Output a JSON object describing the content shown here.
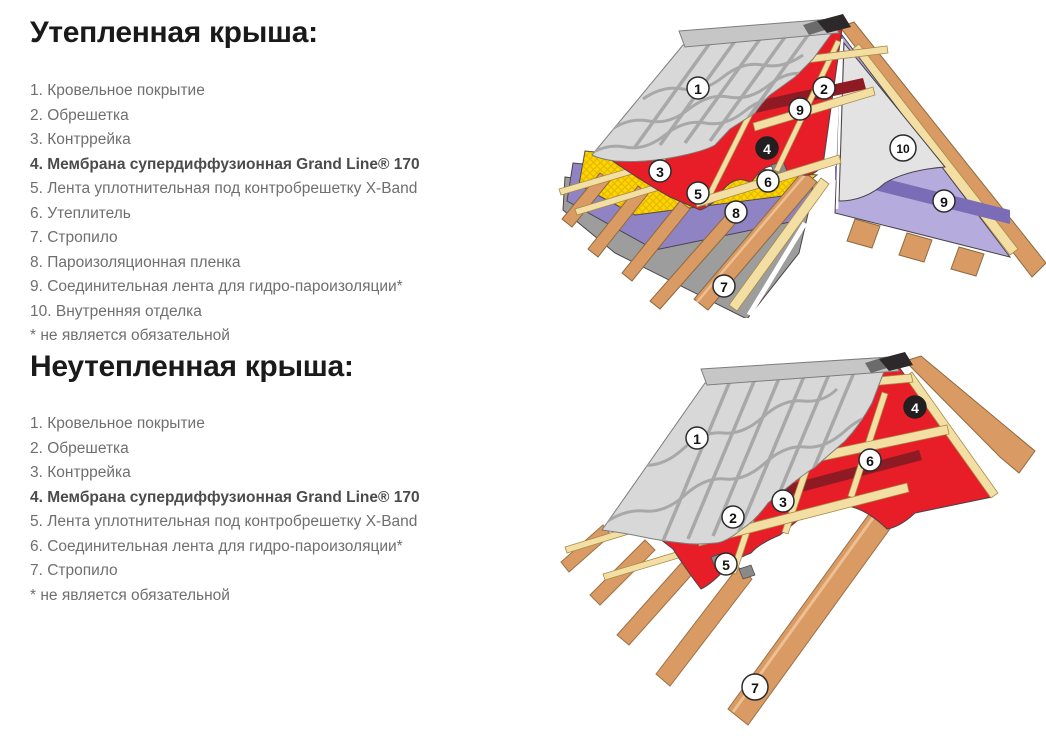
{
  "sections": [
    {
      "title": "Утепленная крыша:",
      "items": [
        {
          "text": "1. Кровельное покрытие",
          "bold": false
        },
        {
          "text": "2. Обрешетка",
          "bold": false
        },
        {
          "text": "3. Контррейка",
          "bold": false
        },
        {
          "text": "4. Мембрана супердиффузионная Grand Line® 170",
          "bold": true
        },
        {
          "text": "5. Лента уплотнительная под контробрешетку X-Band",
          "bold": false
        },
        {
          "text": "6. Утеплитель",
          "bold": false
        },
        {
          "text": "7. Стропило",
          "bold": false
        },
        {
          "text": "8. Пароизоляционная пленка",
          "bold": false
        },
        {
          "text": "9. Соединительная лента для гидро-пароизоляции*",
          "bold": false
        },
        {
          "text": "10. Внутренняя отделка",
          "bold": false
        },
        {
          "text": "* не является обязательной",
          "bold": false
        }
      ]
    },
    {
      "title": "Неутепленная крыша:",
      "items": [
        {
          "text": "1. Кровельное покрытие",
          "bold": false
        },
        {
          "text": "2. Обрешетка",
          "bold": false
        },
        {
          "text": "3. Контррейка",
          "bold": false
        },
        {
          "text": "4. Мембрана супердиффузионная Grand Line® 170",
          "bold": true
        },
        {
          "text": "5. Лента уплотнительная под контробрешетку X-Band",
          "bold": false
        },
        {
          "text": "6. Соединительная лента для гидро-пароизоляции*",
          "bold": false
        },
        {
          "text": "7. Стропило",
          "bold": false
        },
        {
          "text": "* не является обязательной",
          "bold": false
        }
      ]
    }
  ],
  "diagrams": {
    "insulated": {
      "callouts": [
        {
          "n": "1",
          "x": 143,
          "y": 83
        },
        {
          "n": "2",
          "x": 269,
          "y": 83
        },
        {
          "n": "9",
          "x": 245,
          "y": 104
        },
        {
          "n": "4",
          "x": 212,
          "y": 143,
          "dark": true
        },
        {
          "n": "10",
          "x": 348,
          "y": 143,
          "r": 13
        },
        {
          "n": "3",
          "x": 105,
          "y": 166
        },
        {
          "n": "6",
          "x": 213,
          "y": 176
        },
        {
          "n": "5",
          "x": 143,
          "y": 188
        },
        {
          "n": "8",
          "x": 181,
          "y": 207
        },
        {
          "n": "9",
          "x": 389,
          "y": 196
        },
        {
          "n": "7",
          "x": 169,
          "y": 281
        }
      ]
    },
    "uninsulated": {
      "callouts": [
        {
          "n": "1",
          "x": 142,
          "y": 93
        },
        {
          "n": "4",
          "x": 360,
          "y": 62,
          "dark": true
        },
        {
          "n": "6",
          "x": 315,
          "y": 115
        },
        {
          "n": "3",
          "x": 228,
          "y": 156
        },
        {
          "n": "2",
          "x": 178,
          "y": 172
        },
        {
          "n": "5",
          "x": 171,
          "y": 219
        },
        {
          "n": "7",
          "x": 200,
          "y": 342,
          "r": 13
        }
      ]
    }
  },
  "palette": {
    "membrane_red": "#e71e27",
    "tape_dark_red": "#8e1a23",
    "batten_tan": "#f3dfa3",
    "wood_orange": "#d99a63",
    "insulation_yellow": "#ffd400",
    "vapor_film_purple": "#8f83c4",
    "interior_film_lavender": "#b5abdd",
    "interior_tape_purple": "#7b6cb8",
    "sheet_gray": "#9d9d9d",
    "tile_gray": "#d8d8d8",
    "ridge_cap_gray": "#c6c6c6",
    "callout_dark": "#231f20",
    "heading_text": "#1a1a1a",
    "legend_text": "#6f6f6f"
  }
}
